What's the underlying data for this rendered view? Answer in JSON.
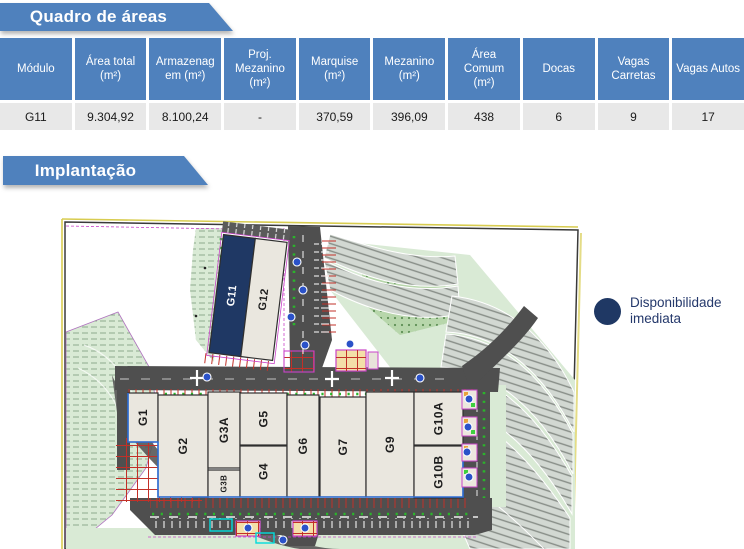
{
  "banners": {
    "quadro_label": "Quadro de áreas",
    "implantacao_label": "Implantação",
    "bg_color": "#4f81bd",
    "text_color": "#ffffff"
  },
  "area_table": {
    "header_bg": "#4f81bd",
    "header_text_color": "#ffffff",
    "row_bg": "#e8e8e8",
    "columns": [
      "Módulo",
      "Área total\n(m²)",
      "Armazenag\nem (m²)",
      "Proj.\nMezanino\n(m²)",
      "Marquise\n(m²)",
      "Mezanino\n(m²)",
      "Área\nComum\n(m²)",
      "Docas",
      "Vagas\nCarretas",
      "Vagas Autos"
    ],
    "rows": [
      [
        "G11",
        "9.304,92",
        "8.100,24",
        "-",
        "370,59",
        "396,09",
        "438",
        "6",
        "9",
        "17"
      ]
    ]
  },
  "legend": {
    "label": "Disponibilidade imediata",
    "swatch_color": "#1f3864",
    "text_color": "#24386b"
  },
  "site_plan": {
    "colors": {
      "available": "#1f3864",
      "building": "#eae7df",
      "road": "#4f4f4f",
      "green": "#d9ead5"
    },
    "buildings": [
      {
        "label": "G11",
        "layer": "upper",
        "x": 216,
        "y": 238,
        "w": 32,
        "h": 119,
        "fill": "#1f3864",
        "color": "#ffffff",
        "fs": 11
      },
      {
        "label": "G12",
        "layer": "upper",
        "x": 248,
        "y": 238,
        "w": 32,
        "h": 119,
        "fs": 11
      },
      {
        "label": "G1",
        "layer": "lower",
        "x": 128,
        "y": 393,
        "w": 30,
        "h": 49
      },
      {
        "label": "G2",
        "layer": "lower",
        "x": 158,
        "y": 395,
        "w": 50,
        "h": 102
      },
      {
        "label": "G3A",
        "layer": "lower",
        "x": 208,
        "y": 392,
        "w": 32,
        "h": 76
      },
      {
        "label": "G3B",
        "layer": "lower",
        "x": 208,
        "y": 470,
        "w": 32,
        "h": 27,
        "fs": 8
      },
      {
        "label": "G5",
        "layer": "lower",
        "x": 240,
        "y": 393,
        "w": 47,
        "h": 52
      },
      {
        "label": "G4",
        "layer": "lower",
        "x": 240,
        "y": 446,
        "w": 47,
        "h": 51
      },
      {
        "label": "G6",
        "layer": "lower",
        "x": 287,
        "y": 395,
        "w": 32,
        "h": 102
      },
      {
        "label": "G7",
        "layer": "lower",
        "x": 320,
        "y": 397,
        "w": 46,
        "h": 100
      },
      {
        "label": "G9",
        "layer": "lower",
        "x": 366,
        "y": 392,
        "w": 48,
        "h": 105
      },
      {
        "label": "G10A",
        "layer": "lower",
        "x": 414,
        "y": 392,
        "w": 49,
        "h": 53
      },
      {
        "label": "G10B",
        "layer": "lower",
        "x": 414,
        "y": 446,
        "w": 49,
        "h": 52
      }
    ]
  }
}
